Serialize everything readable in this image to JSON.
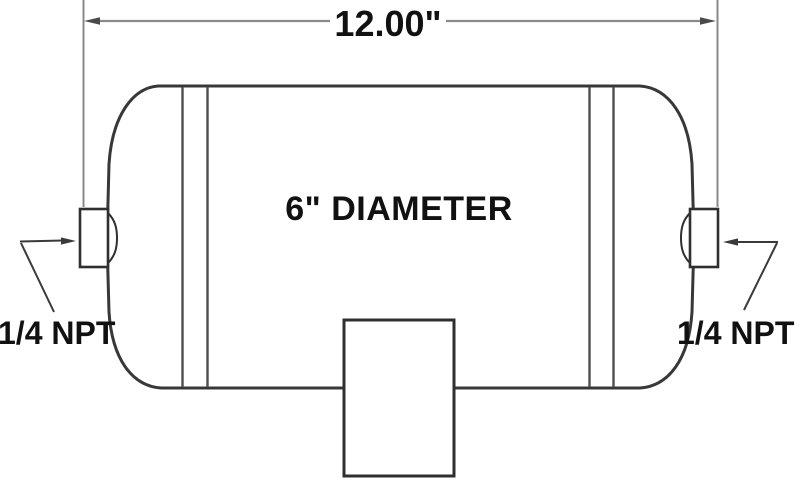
{
  "diagram": {
    "length_label": "12.00\"",
    "diameter_label": "6\" DIAMETER",
    "port_left_label": "1/4 NPT",
    "port_right_label": "1/4 NPT",
    "colors": {
      "background": "#ffffff",
      "tank_outline": "#383838",
      "weld_seam": "#4d4d4d",
      "bracket_outline": "#2f2f2f",
      "dimension_line": "#8a8a8a",
      "leader_line": "#3a3a3a",
      "text": "#111111"
    }
  }
}
